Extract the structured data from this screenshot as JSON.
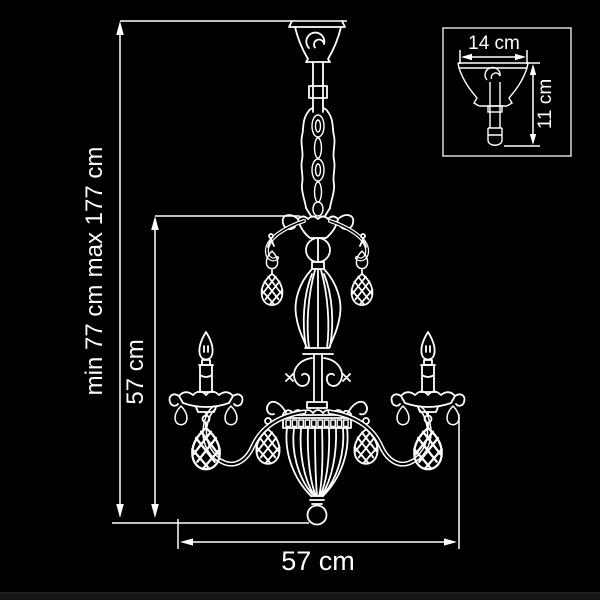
{
  "colors": {
    "background": "#000000",
    "line": "#ffffff"
  },
  "labels": {
    "min_height": "min 77 cm",
    "max_height": "max 177 cm",
    "body_height": "57 cm",
    "width": "57 cm"
  },
  "inset": {
    "width_label": "14 cm",
    "height_label": "11 cm"
  }
}
